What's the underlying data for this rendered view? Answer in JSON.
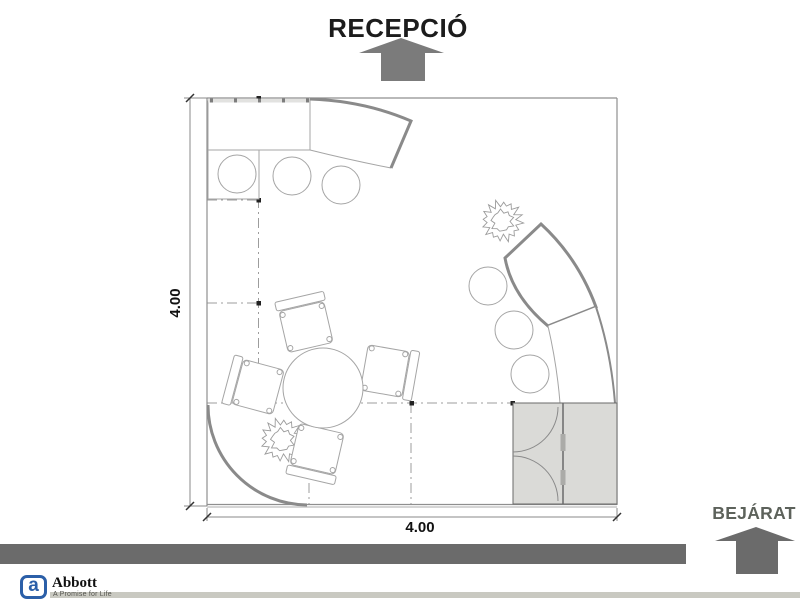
{
  "labels": {
    "reception": "RECEPCIÓ",
    "entrance": "BEJÁRAT"
  },
  "dimensions": {
    "bottom": "4.00",
    "left": "4.00"
  },
  "branding": {
    "name": "Abbott",
    "tagline": "A Promise for Life",
    "logo_letter": "a"
  },
  "colors": {
    "arrow_gray": "#7b7b7b",
    "bar_gray": "#6b6b6b",
    "entrance_text": "#5d625b",
    "counter_stroke": "#8a8a8a",
    "line_gray": "#a5a5a5",
    "wall_gray": "#8f8f8f",
    "grid_gray": "#8c8c8c",
    "storage_fill": "#dadad7",
    "wall_band": "#e2e2e0",
    "brand_blue": "#2b5fa8",
    "rule_gray": "#c9c9c1",
    "title_black": "#1c1c1c",
    "dim_black": "#111111"
  }
}
